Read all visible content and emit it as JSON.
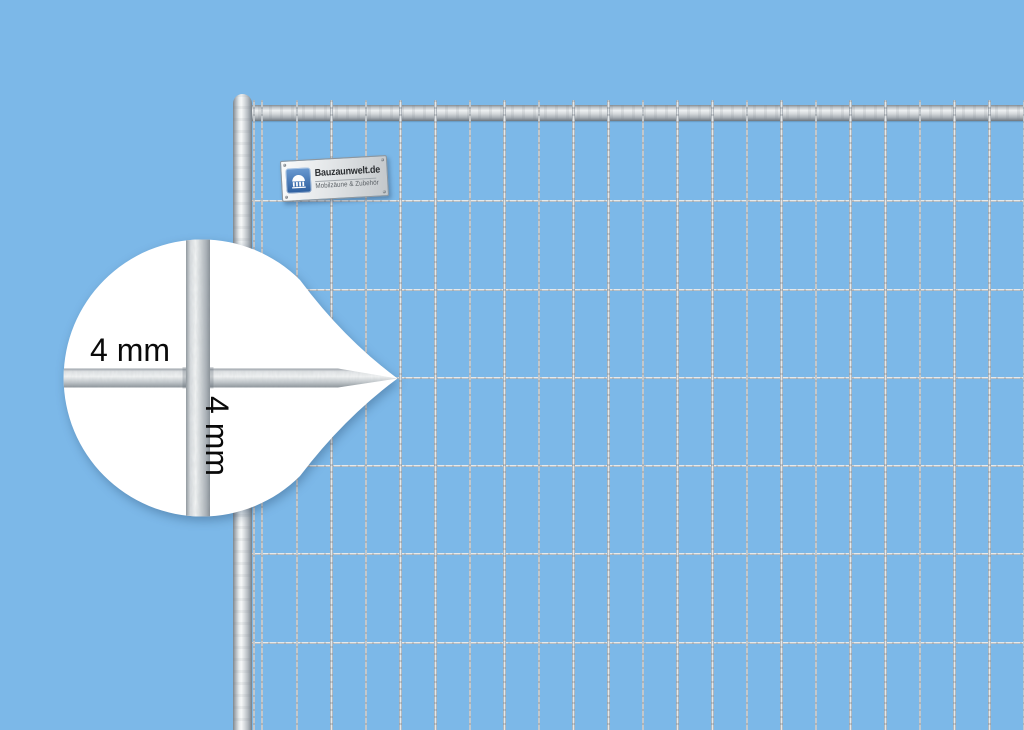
{
  "scene": {
    "background_color": "#7cb8e8"
  },
  "brand_plate": {
    "title": "Bauzaunwelt.de",
    "subtitle": "Mobilzäune & Zubehör"
  },
  "magnifier": {
    "horizontal_wire_label": "4 mm",
    "vertical_wire_label": "4 mm"
  },
  "fence": {
    "metal_color": "#dfe3e6"
  }
}
